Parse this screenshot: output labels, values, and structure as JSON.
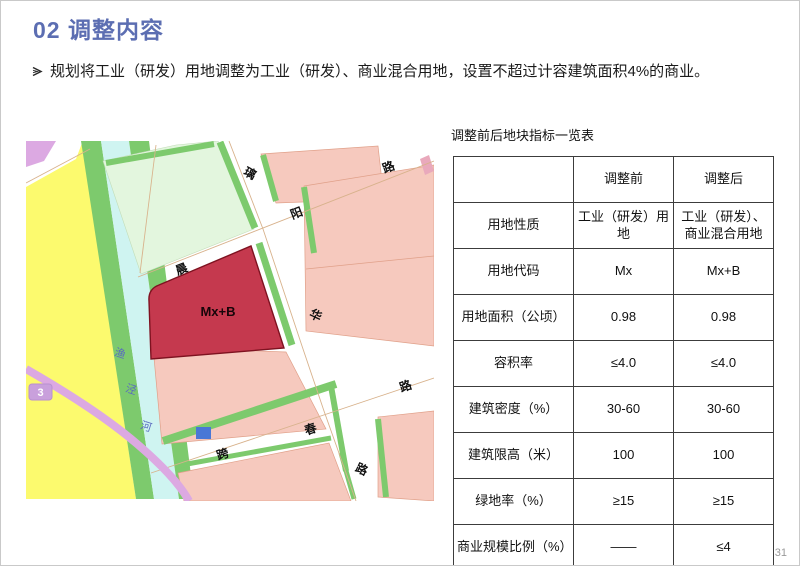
{
  "slide": {
    "title": "02 调整内容",
    "bullet_text": "规划将工业（研发）用地调整为工业（研发）、商业混合用地，设置不超过计容建筑面积4%的商业。",
    "page_number": "31"
  },
  "map": {
    "parcel_label": "Mx+B",
    "badge": "3",
    "river_name": "渔泾河",
    "road_labels": [
      {
        "ch": "璃",
        "x": 222,
        "y": 36,
        "r": 28
      },
      {
        "ch": "路",
        "x": 364,
        "y": 30,
        "r": -21
      },
      {
        "ch": "阳",
        "x": 272,
        "y": 76,
        "r": -21
      },
      {
        "ch": "晨",
        "x": 157,
        "y": 132,
        "r": -21
      },
      {
        "ch": "华",
        "x": 288,
        "y": 178,
        "r": 25
      },
      {
        "ch": "路",
        "x": 381,
        "y": 249,
        "r": -19
      },
      {
        "ch": "春",
        "x": 286,
        "y": 292,
        "r": -19
      },
      {
        "ch": "跨",
        "x": 198,
        "y": 317,
        "r": -19
      },
      {
        "ch": "路",
        "x": 334,
        "y": 332,
        "r": 25
      }
    ],
    "river_labels": [
      {
        "ch": "渔",
        "x": 93,
        "y": 216,
        "r": 18
      },
      {
        "ch": "泾",
        "x": 104,
        "y": 252,
        "r": 18
      },
      {
        "ch": "河",
        "x": 119,
        "y": 289,
        "r": 18
      }
    ],
    "colors": {
      "residential_yellow": "#fcfa6e",
      "river_cyan": "#cff4f1",
      "green_belt": "#7dca6d",
      "mint_parcel": "#e3f6de",
      "pink_parcel": "#f6c9be",
      "red_parcel_mxb": "#c5394e",
      "purple_line": "#dca9e2",
      "blue_parcel": "#4a77d6"
    }
  },
  "table": {
    "title": "调整前后地块指标一览表",
    "columns": [
      "",
      "调整前",
      "调整后"
    ],
    "rows": [
      {
        "label": "用地性质",
        "before": "工业（研发）用地",
        "after": "工业（研发）、商业混合用地"
      },
      {
        "label": "用地代码",
        "before": "Mx",
        "after": "Mx+B"
      },
      {
        "label": "用地面积（公顷）",
        "before": "0.98",
        "after": "0.98"
      },
      {
        "label": "容积率",
        "before": "≤4.0",
        "after": "≤4.0"
      },
      {
        "label": "建筑密度（%）",
        "before": "30-60",
        "after": "30-60"
      },
      {
        "label": "建筑限高（米）",
        "before": "100",
        "after": "100"
      },
      {
        "label": "绿地率（%）",
        "before": "≥15",
        "after": "≥15"
      },
      {
        "label": "商业规模比例（%）",
        "before": "——",
        "after": "≤4"
      }
    ]
  }
}
